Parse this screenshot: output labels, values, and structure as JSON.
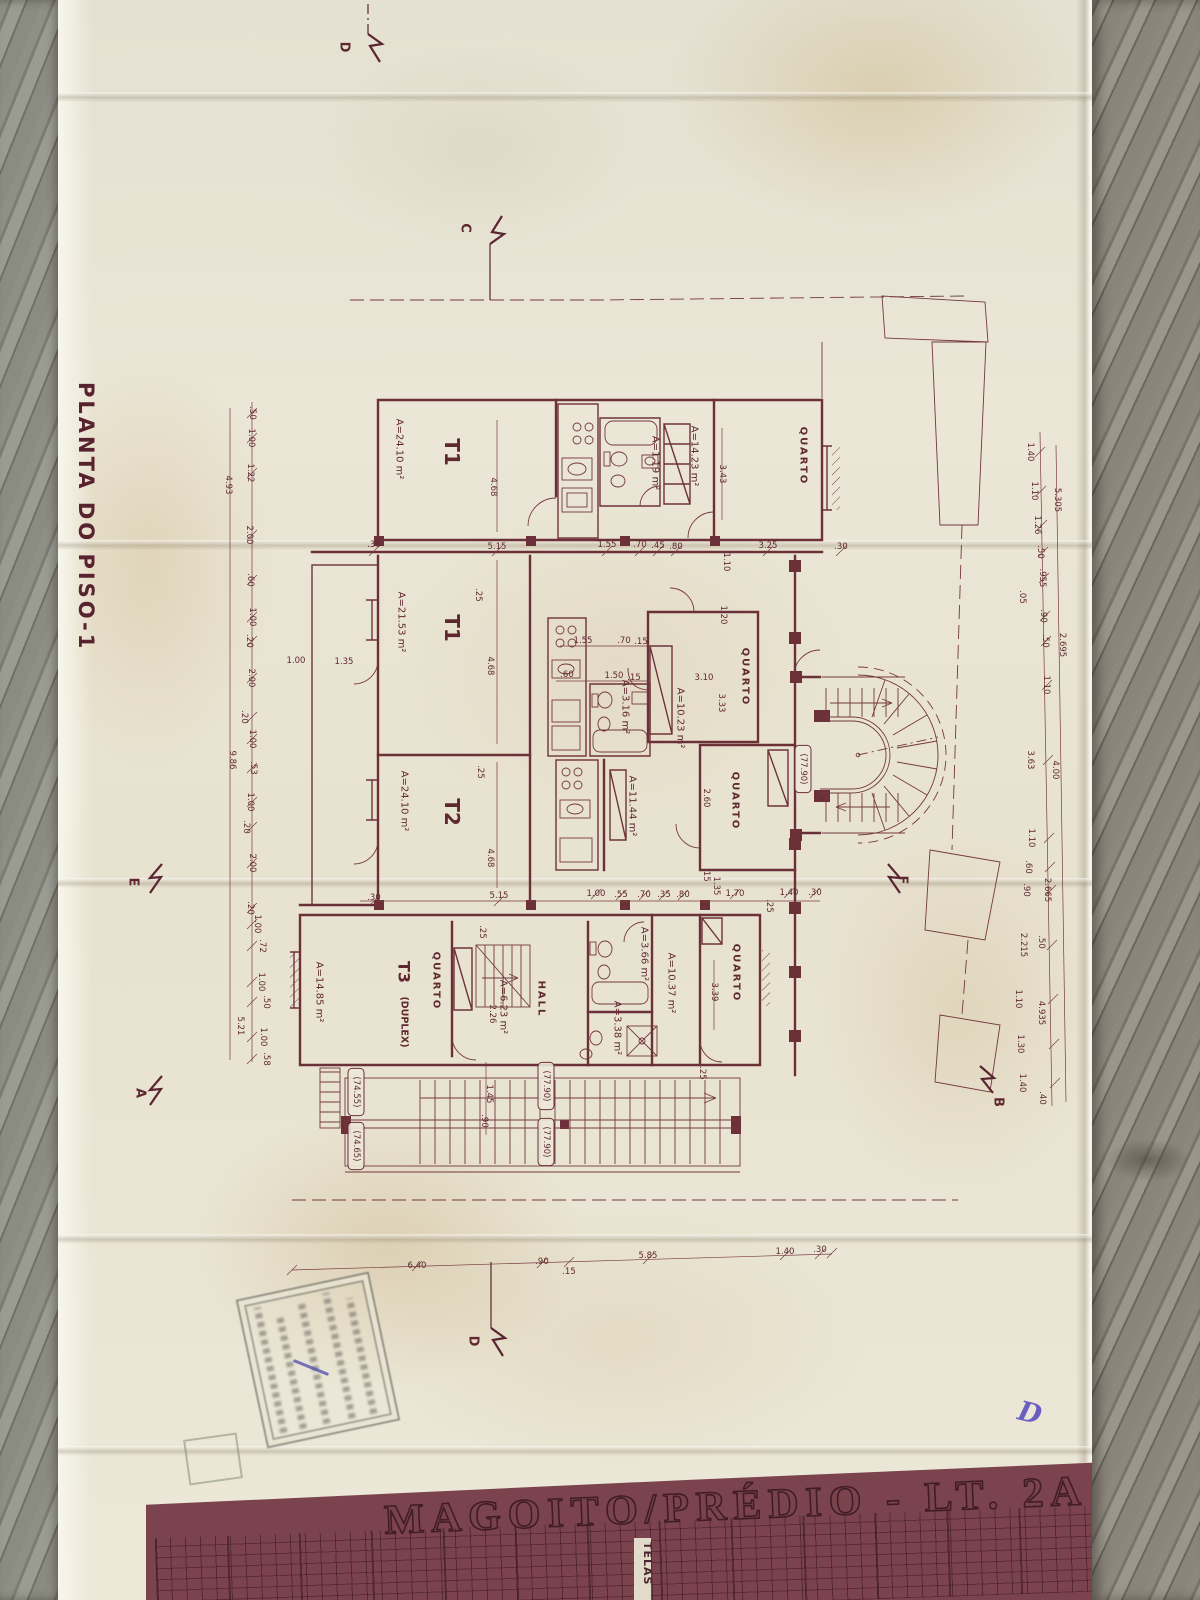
{
  "side_title": "PLANTA DO PISO-1",
  "title_block": {
    "project": "MAGOITO/PRÉDIO - LT. 2A",
    "strip": "TELAS"
  },
  "handwriting": "D",
  "labels": [
    {
      "t": "T1",
      "x": 452,
      "y": 452,
      "k": "big"
    },
    {
      "t": "A=24.10 m²",
      "x": 399,
      "y": 449,
      "k": "area"
    },
    {
      "t": "T1",
      "x": 452,
      "y": 628,
      "k": "big"
    },
    {
      "t": "A=21.53 m²",
      "x": 401,
      "y": 622,
      "k": "area"
    },
    {
      "t": "T2",
      "x": 452,
      "y": 812,
      "k": "big"
    },
    {
      "t": "A=24.10 m²",
      "x": 404,
      "y": 801,
      "k": "area"
    },
    {
      "t": "T3",
      "x": 404,
      "y": 972,
      "k": "t3"
    },
    {
      "t": "(DUPLEX)",
      "x": 404,
      "y": 1022,
      "k": "sub"
    },
    {
      "t": "A=14.85 m²",
      "x": 319,
      "y": 992,
      "k": "area"
    },
    {
      "t": "QUARTO",
      "x": 436,
      "y": 981,
      "k": "rm"
    },
    {
      "t": "A=6.23 m²",
      "x": 503,
      "y": 1007,
      "k": "area"
    },
    {
      "t": "2.26",
      "x": 492,
      "y": 1014,
      "k": "dv"
    },
    {
      "t": "HALL",
      "x": 541,
      "y": 999,
      "k": "rm"
    },
    {
      "t": "A=3.66 m²",
      "x": 644,
      "y": 954,
      "k": "area"
    },
    {
      "t": "A=10.37 m²",
      "x": 671,
      "y": 983,
      "k": "area"
    },
    {
      "t": "QUARTO",
      "x": 736,
      "y": 973,
      "k": "rm"
    },
    {
      "t": "3.39",
      "x": 714,
      "y": 992,
      "k": "dv"
    },
    {
      "t": "A=3.38 m²",
      "x": 617,
      "y": 1028,
      "k": "area"
    },
    {
      "t": "QUARTO",
      "x": 803,
      "y": 456,
      "k": "rm"
    },
    {
      "t": "A=14.23 m²",
      "x": 694,
      "y": 456,
      "k": "area"
    },
    {
      "t": "3.43",
      "x": 722,
      "y": 474,
      "k": "dv"
    },
    {
      "t": "A=1.19 m²",
      "x": 655,
      "y": 463,
      "k": "area"
    },
    {
      "t": "QUARTO",
      "x": 745,
      "y": 677,
      "k": "rm"
    },
    {
      "t": "A=10.23 m²",
      "x": 680,
      "y": 718,
      "k": "area"
    },
    {
      "t": "3.10",
      "x": 704,
      "y": 678,
      "k": "dh"
    },
    {
      "t": "3.33",
      "x": 721,
      "y": 703,
      "k": "dv"
    },
    {
      "t": "QUARTO",
      "x": 735,
      "y": 801,
      "k": "rm"
    },
    {
      "t": "A=11.44 m²",
      "x": 632,
      "y": 806,
      "k": "area"
    },
    {
      "t": "2.60",
      "x": 706,
      "y": 798,
      "k": "dv"
    },
    {
      "t": "A=3.16 m²",
      "x": 625,
      "y": 707,
      "k": "area"
    },
    {
      "t": "(77.90)",
      "x": 803,
      "y": 769,
      "k": "ev"
    },
    {
      "t": "(77.90)",
      "x": 546,
      "y": 1086,
      "k": "ev"
    },
    {
      "t": "(77.90)",
      "x": 546,
      "y": 1142,
      "k": "ev"
    },
    {
      "t": "(74.55)",
      "x": 356,
      "y": 1092,
      "k": "ev"
    },
    {
      "t": "(74.65)",
      "x": 356,
      "y": 1146,
      "k": "ev"
    },
    {
      "t": "D",
      "x": 344,
      "y": 47,
      "k": "mk"
    },
    {
      "t": "C",
      "x": 465,
      "y": 228,
      "k": "mk"
    },
    {
      "t": "E",
      "x": 133,
      "y": 882,
      "k": "mk"
    },
    {
      "t": "F",
      "x": 902,
      "y": 880,
      "k": "mk"
    },
    {
      "t": "A",
      "x": 140,
      "y": 1093,
      "k": "mk"
    },
    {
      "t": "B",
      "x": 998,
      "y": 1102,
      "k": "mk"
    },
    {
      "t": "D",
      "x": 473,
      "y": 1341,
      "k": "mk"
    },
    {
      "t": ".30",
      "x": 374,
      "y": 545,
      "k": "dh"
    },
    {
      "t": "5.15",
      "x": 497,
      "y": 547,
      "k": "dh"
    },
    {
      "t": "1.55",
      "x": 607,
      "y": 545,
      "k": "dh"
    },
    {
      "t": ".70",
      "x": 640,
      "y": 545,
      "k": "dh"
    },
    {
      "t": ".45",
      "x": 658,
      "y": 546,
      "k": "dh"
    },
    {
      "t": ".80",
      "x": 676,
      "y": 547,
      "k": "dh"
    },
    {
      "t": "3.25",
      "x": 768,
      "y": 546,
      "k": "dh"
    },
    {
      "t": ".30",
      "x": 841,
      "y": 547,
      "k": "dh"
    },
    {
      "t": "1.10",
      "x": 726,
      "y": 562,
      "k": "dv"
    },
    {
      "t": "1.20",
      "x": 723,
      "y": 615,
      "k": "dv"
    },
    {
      "t": "4.68",
      "x": 493,
      "y": 487,
      "k": "dv"
    },
    {
      "t": "4.68",
      "x": 490,
      "y": 666,
      "k": "dv"
    },
    {
      "t": "4.68",
      "x": 490,
      "y": 858,
      "k": "dv"
    },
    {
      "t": ".25",
      "x": 478,
      "y": 595,
      "k": "dv"
    },
    {
      "t": ".25",
      "x": 480,
      "y": 772,
      "k": "dv"
    },
    {
      "t": ".25",
      "x": 482,
      "y": 932,
      "k": "dv"
    },
    {
      "t": "1.55",
      "x": 583,
      "y": 641,
      "k": "dh"
    },
    {
      "t": ".70",
      "x": 624,
      "y": 641,
      "k": "dh"
    },
    {
      "t": ".15",
      "x": 641,
      "y": 642,
      "k": "dh"
    },
    {
      "t": ".60",
      "x": 567,
      "y": 675,
      "k": "dh"
    },
    {
      "t": "1.50",
      "x": 614,
      "y": 676,
      "k": "dh"
    },
    {
      "t": ".15",
      "x": 634,
      "y": 678,
      "k": "dh"
    },
    {
      "t": "1.00",
      "x": 296,
      "y": 661,
      "k": "dh"
    },
    {
      "t": "1.35",
      "x": 344,
      "y": 662,
      "k": "dh"
    },
    {
      "t": ".30",
      "x": 374,
      "y": 898,
      "k": "dh"
    },
    {
      "t": "5.15",
      "x": 499,
      "y": 896,
      "k": "dh"
    },
    {
      "t": "1.00",
      "x": 596,
      "y": 894,
      "k": "dh"
    },
    {
      "t": ".55",
      "x": 621,
      "y": 895,
      "k": "dh"
    },
    {
      "t": ".70",
      "x": 644,
      "y": 895,
      "k": "dh"
    },
    {
      "t": ".35",
      "x": 664,
      "y": 895,
      "k": "dh"
    },
    {
      "t": ".80",
      "x": 683,
      "y": 895,
      "k": "dh"
    },
    {
      "t": "1.35",
      "x": 716,
      "y": 886,
      "k": "dv"
    },
    {
      "t": "1.70",
      "x": 735,
      "y": 894,
      "k": "dh"
    },
    {
      "t": "1.40",
      "x": 789,
      "y": 893,
      "k": "dh"
    },
    {
      "t": ".30",
      "x": 815,
      "y": 893,
      "k": "dh"
    },
    {
      "t": ".25",
      "x": 769,
      "y": 906,
      "k": "dv"
    },
    {
      "t": ".15",
      "x": 706,
      "y": 875,
      "k": "dv"
    },
    {
      "t": ".25",
      "x": 702,
      "y": 1073,
      "k": "dv"
    },
    {
      "t": "1.45",
      "x": 489,
      "y": 1094,
      "k": "dv"
    },
    {
      "t": ".90",
      "x": 484,
      "y": 1121,
      "k": "dv"
    },
    {
      "t": "6.40",
      "x": 417,
      "y": 1266,
      "k": "dh"
    },
    {
      "t": ".90",
      "x": 542,
      "y": 1262,
      "k": "dh"
    },
    {
      "t": ".15",
      "x": 569,
      "y": 1272,
      "k": "dh"
    },
    {
      "t": "5.85",
      "x": 648,
      "y": 1256,
      "k": "dh"
    },
    {
      "t": "1.40",
      "x": 785,
      "y": 1252,
      "k": "dh"
    },
    {
      "t": ".30",
      "x": 820,
      "y": 1250,
      "k": "dh"
    },
    {
      "t": ".50",
      "x": 252,
      "y": 413,
      "k": "dv"
    },
    {
      "t": "1.00",
      "x": 251,
      "y": 438,
      "k": "dv"
    },
    {
      "t": "1.22",
      "x": 250,
      "y": 473,
      "k": "dv"
    },
    {
      "t": "4.93",
      "x": 228,
      "y": 485,
      "k": "dv"
    },
    {
      "t": "2.00",
      "x": 249,
      "y": 535,
      "k": "dv"
    },
    {
      "t": ".60",
      "x": 250,
      "y": 580,
      "k": "dv"
    },
    {
      "t": "1.00",
      "x": 252,
      "y": 617,
      "k": "dv"
    },
    {
      "t": ".20",
      "x": 249,
      "y": 641,
      "k": "dv"
    },
    {
      "t": "2.00",
      "x": 251,
      "y": 678,
      "k": "dv"
    },
    {
      "t": ".20",
      "x": 244,
      "y": 717,
      "k": "dv"
    },
    {
      "t": "1.00",
      "x": 252,
      "y": 739,
      "k": "dv"
    },
    {
      "t": "9.86",
      "x": 232,
      "y": 760,
      "k": "dv"
    },
    {
      "t": ".53",
      "x": 253,
      "y": 768,
      "k": "dv"
    },
    {
      "t": "1.00",
      "x": 250,
      "y": 802,
      "k": "dv"
    },
    {
      "t": ".20",
      "x": 246,
      "y": 827,
      "k": "dv"
    },
    {
      "t": "2.00",
      "x": 252,
      "y": 863,
      "k": "dv"
    },
    {
      "t": ".20",
      "x": 250,
      "y": 908,
      "k": "dv"
    },
    {
      "t": "1.00",
      "x": 257,
      "y": 924,
      "k": "dv"
    },
    {
      "t": ".72",
      "x": 262,
      "y": 946,
      "k": "dv"
    },
    {
      "t": "1.00",
      "x": 261,
      "y": 982,
      "k": "dv"
    },
    {
      "t": ".50",
      "x": 266,
      "y": 1002,
      "k": "dv"
    },
    {
      "t": "5.21",
      "x": 240,
      "y": 1026,
      "k": "dv"
    },
    {
      "t": "1.00",
      "x": 263,
      "y": 1037,
      "k": "dv"
    },
    {
      "t": ".58",
      "x": 266,
      "y": 1059,
      "k": "dv"
    },
    {
      "t": "1.40",
      "x": 1030,
      "y": 452,
      "k": "dv"
    },
    {
      "t": "1.10",
      "x": 1034,
      "y": 491,
      "k": "dv"
    },
    {
      "t": "5.305",
      "x": 1057,
      "y": 500,
      "k": "dv"
    },
    {
      "t": "1.26",
      "x": 1037,
      "y": 525,
      "k": "dv"
    },
    {
      "t": ".50",
      "x": 1040,
      "y": 552,
      "k": "dv"
    },
    {
      "t": ".955",
      "x": 1042,
      "y": 578,
      "k": "dv"
    },
    {
      "t": ".05",
      "x": 1022,
      "y": 597,
      "k": "dv"
    },
    {
      "t": ".90",
      "x": 1043,
      "y": 616,
      "k": "dv"
    },
    {
      "t": ".50",
      "x": 1045,
      "y": 641,
      "k": "dv"
    },
    {
      "t": "2.695",
      "x": 1062,
      "y": 645,
      "k": "dv"
    },
    {
      "t": "1.10",
      "x": 1046,
      "y": 685,
      "k": "dv"
    },
    {
      "t": "3.63",
      "x": 1030,
      "y": 760,
      "k": "dv"
    },
    {
      "t": "4.00",
      "x": 1055,
      "y": 770,
      "k": "dv"
    },
    {
      "t": "1.10",
      "x": 1031,
      "y": 838,
      "k": "dv"
    },
    {
      "t": ".60",
      "x": 1028,
      "y": 867,
      "k": "dv"
    },
    {
      "t": ".90",
      "x": 1026,
      "y": 890,
      "k": "dv"
    },
    {
      "t": "2.665",
      "x": 1047,
      "y": 890,
      "k": "dv"
    },
    {
      "t": "2.215",
      "x": 1023,
      "y": 945,
      "k": "dv"
    },
    {
      "t": ".50",
      "x": 1041,
      "y": 942,
      "k": "dv"
    },
    {
      "t": "1.10",
      "x": 1018,
      "y": 999,
      "k": "dv"
    },
    {
      "t": "4.935",
      "x": 1041,
      "y": 1013,
      "k": "dv"
    },
    {
      "t": "1.30",
      "x": 1020,
      "y": 1044,
      "k": "dv"
    },
    {
      "t": "1.40",
      "x": 1022,
      "y": 1083,
      "k": "dv"
    },
    {
      "t": ".40",
      "x": 1042,
      "y": 1098,
      "k": "dv"
    }
  ]
}
